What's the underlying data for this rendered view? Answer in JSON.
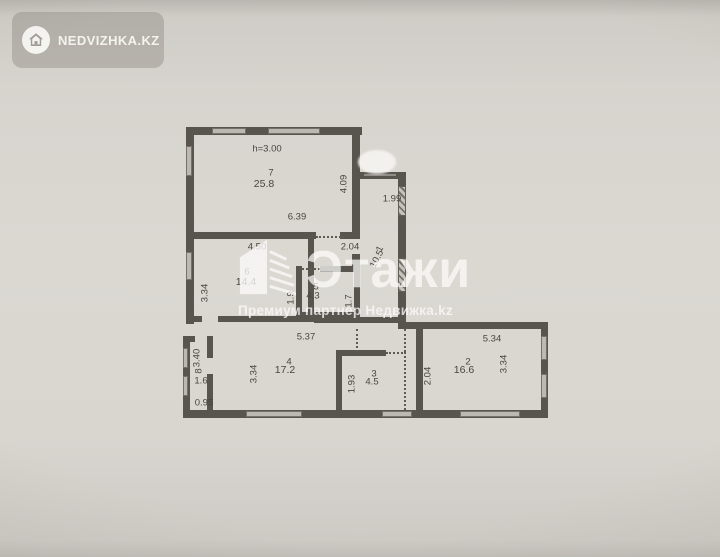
{
  "badge": {
    "text": "NEDVIZHKA.KZ"
  },
  "watermark": {
    "brand": "Этажи",
    "subtitle": "Премиум партнер Недвижка.kz"
  },
  "plan": {
    "ceiling_height": "h=3.00",
    "rooms": {
      "r1": {
        "num": "1",
        "area": "10.5"
      },
      "r2": {
        "num": "2",
        "area": "16.6"
      },
      "r3": {
        "num": "3",
        "area": "4.5"
      },
      "r4": {
        "num": "4",
        "area": "17.2"
      },
      "r5": {
        "num": "5",
        "area": "4.3"
      },
      "r6": {
        "num": "6",
        "area": "14.4"
      },
      "r7": {
        "num": "7",
        "area": "25.8"
      },
      "r8": {
        "num": "8",
        "area": "1.6"
      }
    },
    "dims": {
      "room7_width": "6.39",
      "room7_depth": "4.09",
      "entry_width": "1.99",
      "room6_width": "4.50",
      "room6_depth": "3.34",
      "lobby_width": "2.04",
      "bath5_left": "1.9",
      "bath5_right": "1.7",
      "hall_width": "5.37",
      "room4_depth": "3.34",
      "room3_left": "1.93",
      "room3_right": "2.04",
      "room2_width": "5.34",
      "room2_depth": "3.34",
      "balcony_length": "3.40",
      "balcony_width": "0.95"
    }
  }
}
